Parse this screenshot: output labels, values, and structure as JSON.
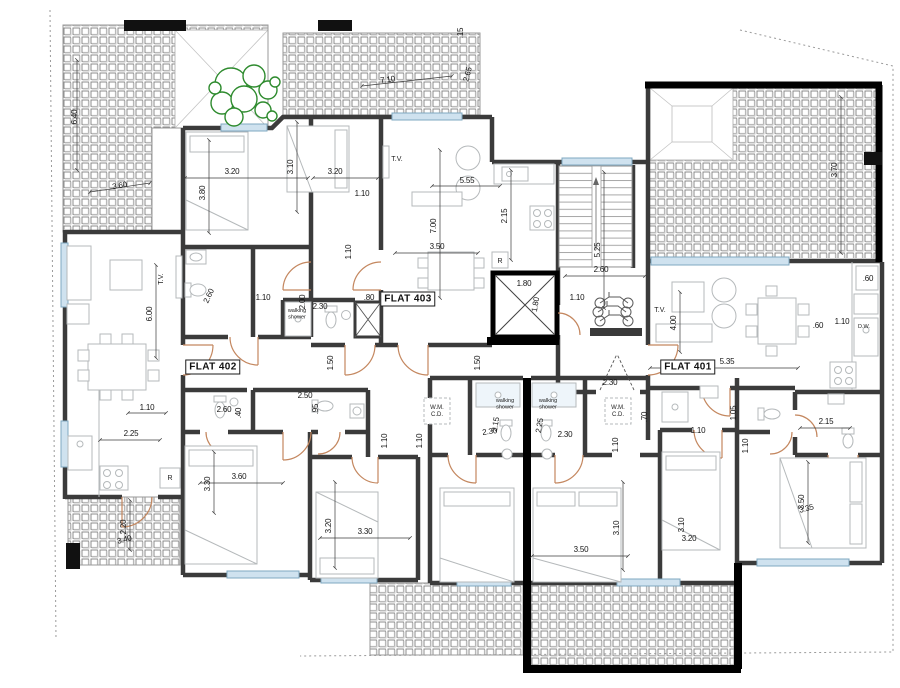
{
  "flat_labels": [
    {
      "text": "FLAT 402",
      "x": 213,
      "y": 367
    },
    {
      "text": "FLAT 403",
      "x": 408,
      "y": 299
    },
    {
      "text": "FLAT 401",
      "x": 688,
      "y": 367
    }
  ],
  "room_labels": [
    {
      "lines": [
        "T.V."
      ],
      "x": 397,
      "y": 161,
      "r": 0,
      "size": 7
    },
    {
      "lines": [
        "T.V."
      ],
      "x": 163,
      "y": 279,
      "r": -90,
      "size": 7
    },
    {
      "lines": [
        "T.V."
      ],
      "x": 660,
      "y": 312,
      "r": 0,
      "size": 7
    },
    {
      "lines": [
        "R"
      ],
      "x": 500,
      "y": 263,
      "r": 0,
      "size": 7
    },
    {
      "lines": [
        "R"
      ],
      "x": 170,
      "y": 480,
      "r": 0,
      "size": 7
    },
    {
      "lines": [
        "D.W."
      ],
      "x": 864,
      "y": 328,
      "r": 0,
      "size": 5.5
    },
    {
      "lines": [
        "walking",
        "shower"
      ],
      "x": 297,
      "y": 312,
      "r": 0,
      "size": 5.5
    },
    {
      "lines": [
        "walking",
        "shower"
      ],
      "x": 505,
      "y": 402,
      "r": 0,
      "size": 5.5
    },
    {
      "lines": [
        "walking",
        "shower"
      ],
      "x": 548,
      "y": 402,
      "r": 0,
      "size": 5.5
    },
    {
      "lines": [
        "W.M.",
        "C.D."
      ],
      "x": 437,
      "y": 409,
      "r": 0,
      "size": 6
    },
    {
      "lines": [
        "W.M.",
        "C.D."
      ],
      "x": 618,
      "y": 409,
      "r": 0,
      "size": 6
    }
  ],
  "dimensions": [
    {
      "t": "6.40",
      "x": 77,
      "y": 117,
      "r": -90
    },
    {
      "t": "3.60",
      "x": 120,
      "y": 188,
      "r": -10
    },
    {
      "t": "7.10",
      "x": 388,
      "y": 82,
      "r": -8
    },
    {
      "t": ".15",
      "x": 463,
      "y": 33,
      "r": -90
    },
    {
      "t": "2.65",
      "x": 470,
      "y": 75,
      "r": -75
    },
    {
      "t": "3.20",
      "x": 232,
      "y": 174,
      "r": 0
    },
    {
      "t": "3.80",
      "x": 205,
      "y": 193,
      "r": -90
    },
    {
      "t": "3.10",
      "x": 293,
      "y": 167,
      "r": -90
    },
    {
      "t": "3.20",
      "x": 335,
      "y": 174,
      "r": 0
    },
    {
      "t": "1.10",
      "x": 362,
      "y": 196,
      "r": 0
    },
    {
      "t": "5.55",
      "x": 467,
      "y": 183,
      "r": 0
    },
    {
      "t": "7.00",
      "x": 436,
      "y": 226,
      "r": -90
    },
    {
      "t": "2.15",
      "x": 507,
      "y": 216,
      "r": -90
    },
    {
      "t": "3.70",
      "x": 837,
      "y": 170,
      "r": -90
    },
    {
      "t": "5.25",
      "x": 600,
      "y": 250,
      "r": -90
    },
    {
      "t": "2.60",
      "x": 601,
      "y": 272,
      "r": 0
    },
    {
      "t": "1.10",
      "x": 351,
      "y": 252,
      "r": -90
    },
    {
      "t": "3.50",
      "x": 437,
      "y": 249,
      "r": 0
    },
    {
      "t": "1.10",
      "x": 263,
      "y": 300,
      "r": 0
    },
    {
      "t": "2.60",
      "x": 211,
      "y": 297,
      "r": -65
    },
    {
      "t": "2.00",
      "x": 305,
      "y": 302,
      "r": -90
    },
    {
      "t": "2.30",
      "x": 320,
      "y": 309,
      "r": 0
    },
    {
      "t": ".80",
      "x": 369,
      "y": 300,
      "r": 0
    },
    {
      "t": "1.80",
      "x": 524,
      "y": 286,
      "r": 0
    },
    {
      "t": "1.80",
      "x": 538,
      "y": 305,
      "r": -80
    },
    {
      "t": "1.10",
      "x": 577,
      "y": 300,
      "r": 0
    },
    {
      "t": "6.00",
      "x": 152,
      "y": 314,
      "r": -90
    },
    {
      "t": "1.50",
      "x": 333,
      "y": 363,
      "r": -90
    },
    {
      "t": "1.50",
      "x": 480,
      "y": 363,
      "r": -90
    },
    {
      "t": "4.00",
      "x": 676,
      "y": 323,
      "r": -90
    },
    {
      "t": "5.35",
      "x": 727,
      "y": 364,
      "r": 0
    },
    {
      "t": ".60",
      "x": 818,
      "y": 328,
      "r": 0
    },
    {
      "t": "1.10",
      "x": 842,
      "y": 324,
      "r": 0
    },
    {
      "t": ".60",
      "x": 868,
      "y": 281,
      "r": 0
    },
    {
      "t": "1.10",
      "x": 147,
      "y": 410,
      "r": 0
    },
    {
      "t": "2.25",
      "x": 131,
      "y": 436,
      "r": 0
    },
    {
      "t": "2.60",
      "x": 224,
      "y": 412,
      "r": 0
    },
    {
      "t": ".40",
      "x": 241,
      "y": 413,
      "r": -90
    },
    {
      "t": "2.50",
      "x": 305,
      "y": 398,
      "r": 0
    },
    {
      "t": ".95",
      "x": 318,
      "y": 409,
      "r": -90
    },
    {
      "t": "2.15",
      "x": 498,
      "y": 425,
      "r": -80
    },
    {
      "t": "2.30",
      "x": 490,
      "y": 434,
      "r": -8
    },
    {
      "t": "2.25",
      "x": 542,
      "y": 426,
      "r": -80
    },
    {
      "t": "2.30",
      "x": 565,
      "y": 437,
      "r": 0
    },
    {
      "t": "2.30",
      "x": 610,
      "y": 385,
      "r": 0
    },
    {
      "t": "1.10",
      "x": 387,
      "y": 441,
      "r": -90
    },
    {
      "t": "1.10",
      "x": 422,
      "y": 441,
      "r": -90
    },
    {
      "t": "1.10",
      "x": 618,
      "y": 445,
      "r": -90
    },
    {
      "t": ".70",
      "x": 647,
      "y": 417,
      "r": -90
    },
    {
      "t": "1.05",
      "x": 736,
      "y": 413,
      "r": -90
    },
    {
      "t": "1.10",
      "x": 698,
      "y": 433,
      "r": 0
    },
    {
      "t": "1.10",
      "x": 748,
      "y": 446,
      "r": -90
    },
    {
      "t": "2.15",
      "x": 826,
      "y": 424,
      "r": 0
    },
    {
      "t": "3.60",
      "x": 239,
      "y": 479,
      "r": 0
    },
    {
      "t": "3.30",
      "x": 210,
      "y": 484,
      "r": -90
    },
    {
      "t": "3.20",
      "x": 331,
      "y": 526,
      "r": -90
    },
    {
      "t": "3.30",
      "x": 365,
      "y": 534,
      "r": 0
    },
    {
      "t": "2.20",
      "x": 126,
      "y": 527,
      "r": -90
    },
    {
      "t": "3.40",
      "x": 125,
      "y": 542,
      "r": -15
    },
    {
      "t": "3.10",
      "x": 619,
      "y": 528,
      "r": -90
    },
    {
      "t": "3.10",
      "x": 684,
      "y": 525,
      "r": -90
    },
    {
      "t": "3.20",
      "x": 689,
      "y": 541,
      "r": 0
    },
    {
      "t": "3.50",
      "x": 581,
      "y": 552,
      "r": 0
    },
    {
      "t": "3.50",
      "x": 804,
      "y": 502,
      "r": -90
    },
    {
      "t": "3.35",
      "x": 807,
      "y": 511,
      "r": -15
    }
  ],
  "colors": {
    "wall": "#3b3b3b",
    "boundary": "#000000",
    "hatch_line": "#808080",
    "window": "#cfe2ef",
    "door": "#c4875f",
    "plant": "#2e8b2e",
    "furniture": "#b5b9bb",
    "dimension_text": "#161616"
  }
}
